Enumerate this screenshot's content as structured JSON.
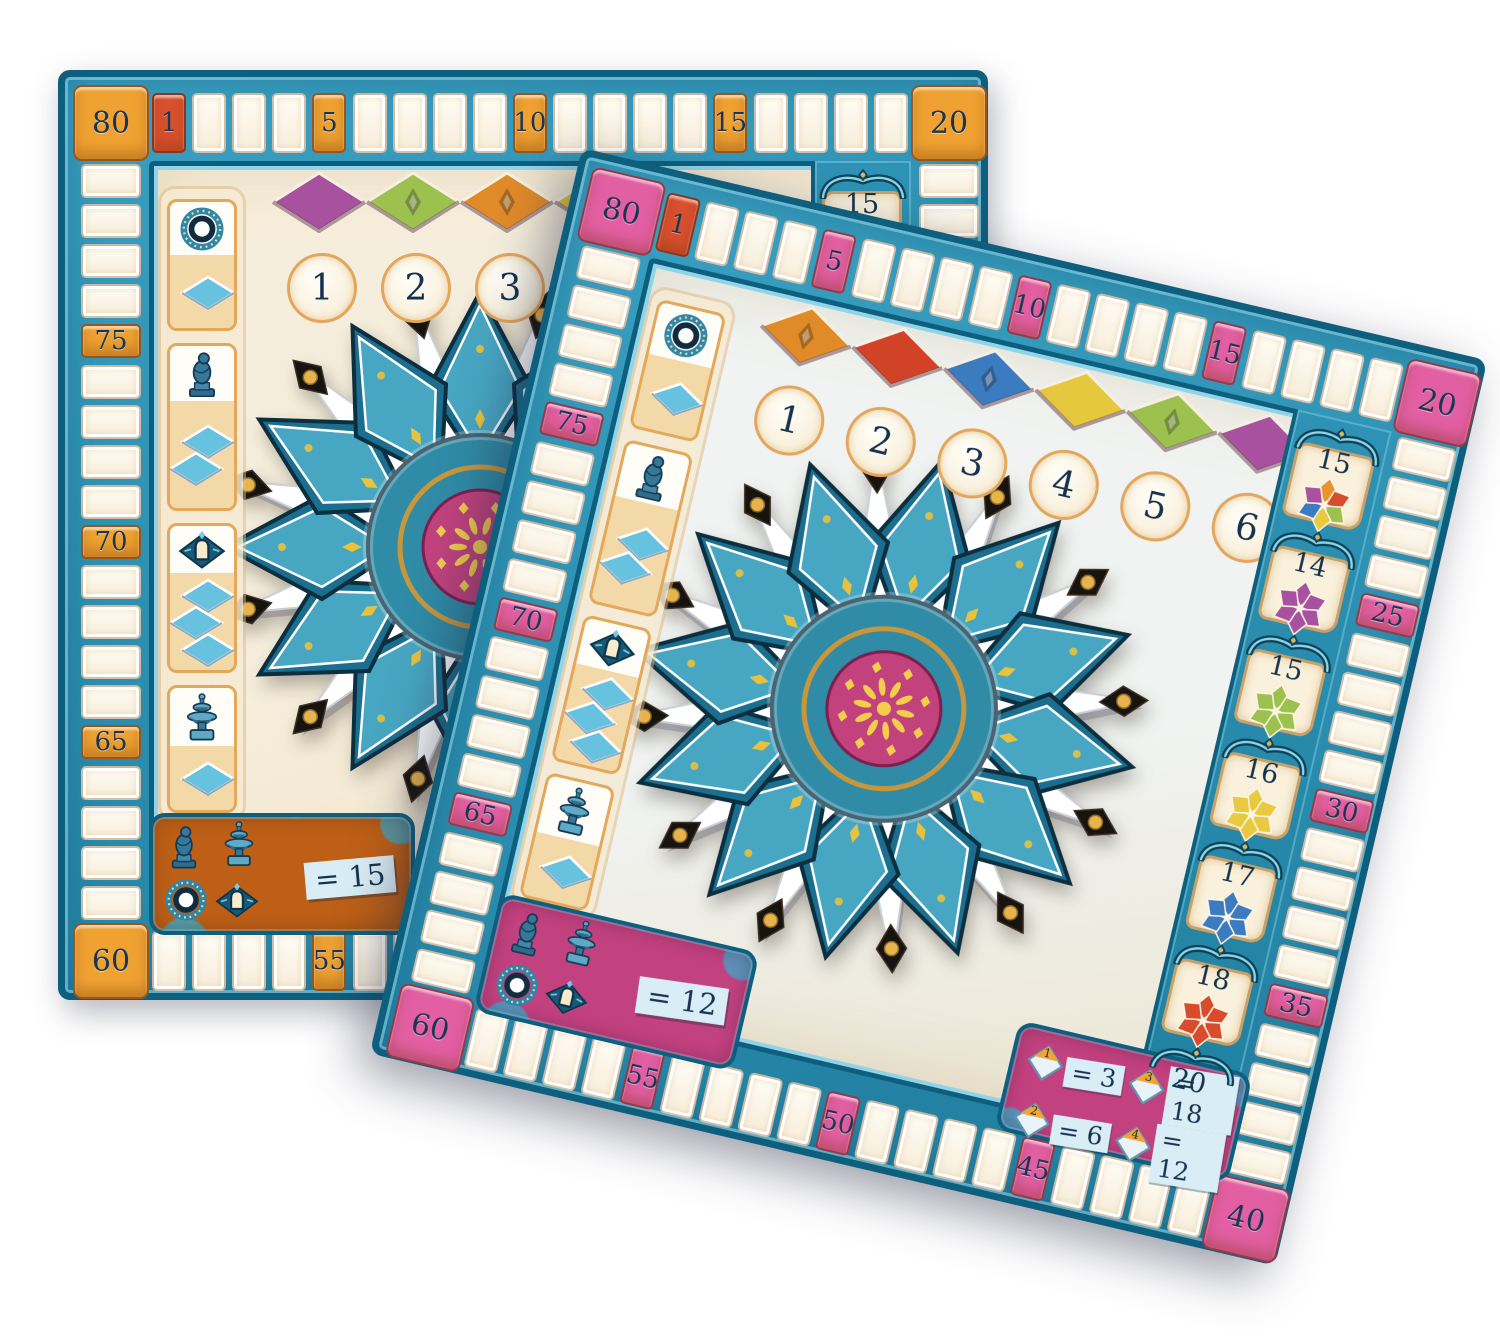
{
  "palette": {
    "frame_teal": "#2E92B4",
    "frame_dark": "#0E5F7E",
    "frame_light": "#8FD4E8",
    "cell_cream": "#FBF4E6",
    "number_ink": "#1B3550",
    "red_space": "#D9502E",
    "tile_blue": "#66C2DE",
    "icon_steel": "#37789A",
    "gold": "#C9973B",
    "petal_dark": "#1C6E8E",
    "petal_mid": "#47A6C2",
    "petal_edge": "#0C2F40",
    "flower_center_teal": "#2F8BA6",
    "white_star": "#FFFFFF",
    "black_diamond": "#17130F"
  },
  "boards": {
    "back": {
      "accent": "#EFA232",
      "accent_deep": "#D07F16",
      "panel_color": "#BD5F16",
      "inner_top": "#F6EEDC",
      "inner_bottom": "#EFE2C5",
      "milestones": {
        "0": "80",
        "1": "1",
        "5": "5",
        "10": "10",
        "15": "15",
        "20": "20",
        "55": "55",
        "60": "60",
        "65": "65",
        "70": "70",
        "75": "75"
      },
      "red_step": 1,
      "diamond_row": [
        {
          "color": "#A8519E",
          "emblem": false
        },
        {
          "color": "#9CC14F",
          "emblem": true
        },
        {
          "color": "#E08A28",
          "emblem": true
        },
        {
          "color": "#E6C83E",
          "emblem": false
        }
      ],
      "circles": [
        "1",
        "2",
        "3",
        "4"
      ],
      "left_column": [
        {
          "icon": "pillar-ring",
          "tiles": 1
        },
        {
          "icon": "statue",
          "tiles": 2
        },
        {
          "icon": "window",
          "tiles": 3
        },
        {
          "icon": "fountain",
          "tiles": 1
        }
      ],
      "badges": [
        {
          "value": "15",
          "star": "trio",
          "colors": [
            "#D14227",
            "#A8519E",
            "#9CC14F"
          ]
        }
      ],
      "panel": {
        "label": "= 15",
        "icons": [
          "statue",
          "fountain",
          "pillar-ring",
          "window"
        ]
      },
      "flower_core": "#C2427E",
      "corner_panel": null
    },
    "front": {
      "accent": "#E35FA3",
      "accent_deep": "#C23484",
      "panel_color": "#C2417F",
      "inner_top": "#F0F3F1",
      "inner_bottom": "#ECE4D0",
      "milestones": {
        "0": "80",
        "1": "1",
        "5": "5",
        "10": "10",
        "15": "15",
        "20": "20",
        "25": "25",
        "30": "30",
        "35": "35",
        "40": "40",
        "45": "45",
        "50": "50",
        "55": "55",
        "60": "60",
        "65": "65",
        "70": "70",
        "75": "75"
      },
      "red_step": 1,
      "diamond_row": [
        {
          "color": "#E08A28",
          "emblem": true
        },
        {
          "color": "#D14227",
          "emblem": false
        },
        {
          "color": "#3B7BBF",
          "emblem": true
        },
        {
          "color": "#E6C83E",
          "emblem": false
        },
        {
          "color": "#9CC14F",
          "emblem": true
        },
        {
          "color": "#A8519E",
          "emblem": false
        }
      ],
      "circles": [
        "1",
        "2",
        "3",
        "4",
        "5",
        "6"
      ],
      "left_column": [
        {
          "icon": "pillar-ring",
          "tiles": 1
        },
        {
          "icon": "statue",
          "tiles": 2
        },
        {
          "icon": "window",
          "tiles": 3
        },
        {
          "icon": "fountain",
          "tiles": 1
        }
      ],
      "badges": [
        {
          "value": "15",
          "star": "multi",
          "colors": [
            "#E8932D",
            "#D84B2B",
            "#9CC14F",
            "#E9C93F",
            "#3B7BBF",
            "#A8519E"
          ]
        },
        {
          "value": "14",
          "star": "solid",
          "colors": [
            "#A8519E"
          ]
        },
        {
          "value": "15",
          "star": "solid",
          "colors": [
            "#9CC14F"
          ]
        },
        {
          "value": "16",
          "star": "solid",
          "colors": [
            "#E9C93F"
          ]
        },
        {
          "value": "17",
          "star": "solid",
          "colors": [
            "#3B7BBF"
          ]
        },
        {
          "value": "18",
          "star": "solid",
          "colors": [
            "#D84B2B"
          ]
        },
        {
          "value": "20",
          "star": "solid",
          "colors": [
            "#E8932D"
          ]
        }
      ],
      "panel": {
        "label": "= 12",
        "icons": [
          "statue",
          "fountain",
          "pillar-ring",
          "window"
        ]
      },
      "flower_core": "#C2427E",
      "corner_panel": {
        "entries": [
          {
            "num": "1",
            "value": "= 3"
          },
          {
            "num": "3",
            "value": "= 18"
          },
          {
            "num": "2",
            "value": "= 6"
          },
          {
            "num": "4",
            "value": "= 12"
          }
        ]
      }
    }
  }
}
